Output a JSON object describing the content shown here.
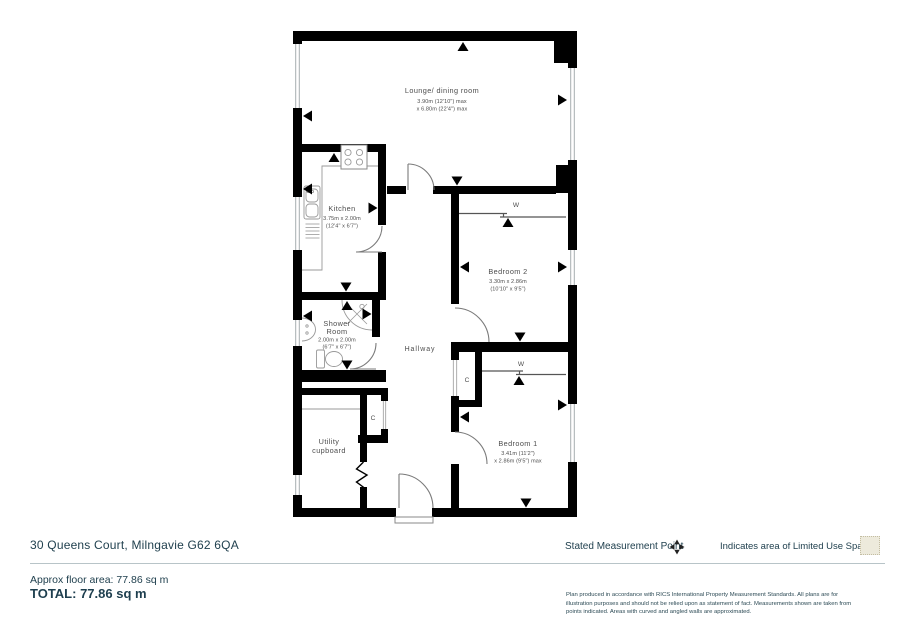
{
  "plan": {
    "lounge": {
      "name": "Lounge/ dining room",
      "dim1": "3.90m (12'10\") max",
      "dim2": "x 6.80m (22'4\") max"
    },
    "kitchen": {
      "name": "Kitchen",
      "dim1": "3.75m x 2.00m",
      "dim2": "(12'4\" x 6'7\")"
    },
    "shower": {
      "name_line1": "Shower",
      "name_line2": "Room",
      "dim1": "2.00m x 2.00m",
      "dim2": "(6'7\" x 6'7\")"
    },
    "hallway": {
      "name": "Hallway"
    },
    "utility": {
      "name_line1": "Utility",
      "name_line2": "cupboard"
    },
    "bedroom2": {
      "name": "Bedroom 2",
      "dim1": "3.30m x 2.86m",
      "dim2": "(10'10\" x 9'5\")"
    },
    "bedroom1": {
      "name": "Bedroom 1",
      "dim1": "3.41m (11'2\")",
      "dim2": "x 2.86m (9'5\") max"
    },
    "wardrobe_label": "W",
    "cupboard_label": "C"
  },
  "footer": {
    "address": "30 Queens Court, Milngavie G62 6QA",
    "legend_measurement": "Stated Measurement Point",
    "legend_limited_use": "Indicates area of  Limited Use Space",
    "approx_area": "Approx floor area: 77.86 sq m",
    "total": "TOTAL: 77.86 sq m",
    "disclaimer": "Plan produced in accordance with RICS International Property Measurement Standards.  All plans are for illustration purposes and should not be relied upon as statement of fact.  Measurements shown are taken from points indicated. Areas with curved and angled walls are approximated."
  },
  "colors": {
    "wall": "#000000",
    "plan_text": "#4d4d4d",
    "footer_text": "#21414f",
    "rule": "#b8c4c8",
    "limited_use_fill": "#edeadc",
    "limited_use_border": "#c3bda2"
  }
}
